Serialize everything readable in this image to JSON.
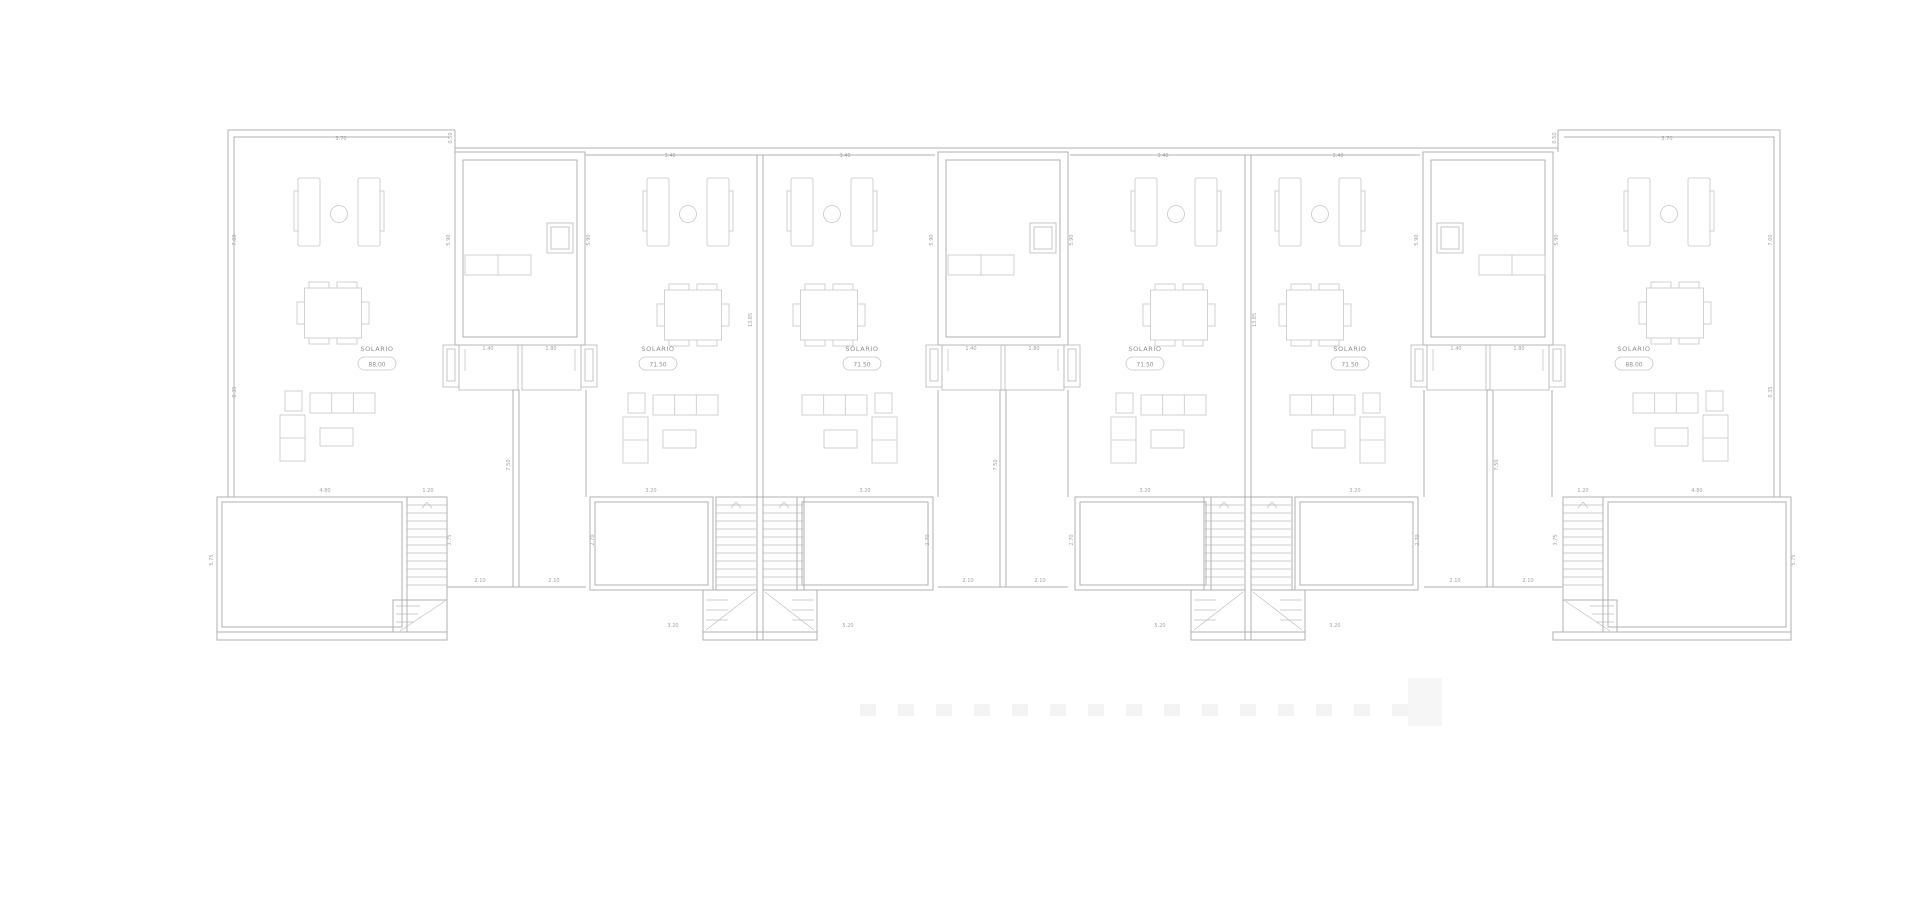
{
  "document": {
    "type": "architectural-floor-plan",
    "level_label": "SOLARIO"
  },
  "plan": {
    "solario_labels": [
      {
        "label": "SOLARIO",
        "value": "88.00",
        "x": 377,
        "y": 351
      },
      {
        "label": "SOLARIO",
        "value": "71.50",
        "x": 658,
        "y": 351
      },
      {
        "label": "SOLARIO",
        "value": "71.50",
        "x": 862,
        "y": 351
      },
      {
        "label": "SOLARIO",
        "value": "71.50",
        "x": 1145,
        "y": 351
      },
      {
        "label": "SOLARIO",
        "value": "71.50",
        "x": 1350,
        "y": 351
      },
      {
        "label": "SOLARIO",
        "value": "88.00",
        "x": 1634,
        "y": 351
      }
    ],
    "dimensions": [
      {
        "text": "3.70",
        "x": 341,
        "y": 140,
        "vertical": false
      },
      {
        "text": "3.40",
        "x": 670,
        "y": 157,
        "vertical": false
      },
      {
        "text": "3.40",
        "x": 845,
        "y": 157,
        "vertical": false
      },
      {
        "text": "3.40",
        "x": 1163,
        "y": 157,
        "vertical": false
      },
      {
        "text": "3.40",
        "x": 1338,
        "y": 157,
        "vertical": false
      },
      {
        "text": "3.70",
        "x": 1667,
        "y": 140,
        "vertical": false
      },
      {
        "text": "4.80",
        "x": 325,
        "y": 492,
        "vertical": false
      },
      {
        "text": "1.20",
        "x": 428,
        "y": 492,
        "vertical": false
      },
      {
        "text": "3.20",
        "x": 651,
        "y": 492,
        "vertical": false
      },
      {
        "text": "3.20",
        "x": 865,
        "y": 492,
        "vertical": false
      },
      {
        "text": "3.20",
        "x": 1145,
        "y": 492,
        "vertical": false
      },
      {
        "text": "3.20",
        "x": 1355,
        "y": 492,
        "vertical": false
      },
      {
        "text": "1.20",
        "x": 1583,
        "y": 492,
        "vertical": false
      },
      {
        "text": "4.80",
        "x": 1697,
        "y": 492,
        "vertical": false
      },
      {
        "text": "2.10",
        "x": 480,
        "y": 582,
        "vertical": false
      },
      {
        "text": "2.10",
        "x": 554,
        "y": 582,
        "vertical": false
      },
      {
        "text": "2.10",
        "x": 968,
        "y": 582,
        "vertical": false
      },
      {
        "text": "2.10",
        "x": 1040,
        "y": 582,
        "vertical": false
      },
      {
        "text": "2.10",
        "x": 1455,
        "y": 582,
        "vertical": false
      },
      {
        "text": "2.10",
        "x": 1528,
        "y": 582,
        "vertical": false
      },
      {
        "text": "3.20",
        "x": 673,
        "y": 627,
        "vertical": false
      },
      {
        "text": "5.20",
        "x": 848,
        "y": 627,
        "vertical": false
      },
      {
        "text": "5.20",
        "x": 1160,
        "y": 627,
        "vertical": false
      },
      {
        "text": "3.20",
        "x": 1335,
        "y": 627,
        "vertical": false
      },
      {
        "text": "1.40",
        "x": 488,
        "y": 350,
        "vertical": false
      },
      {
        "text": "1.80",
        "x": 551,
        "y": 350,
        "vertical": false
      },
      {
        "text": "1.40",
        "x": 971,
        "y": 350,
        "vertical": false
      },
      {
        "text": "1.80",
        "x": 1034,
        "y": 350,
        "vertical": false
      },
      {
        "text": "1.40",
        "x": 1456,
        "y": 350,
        "vertical": false
      },
      {
        "text": "1.80",
        "x": 1519,
        "y": 350,
        "vertical": false
      },
      {
        "text": "7.00",
        "x": 236,
        "y": 240,
        "vertical": true
      },
      {
        "text": "7.00",
        "x": 1772,
        "y": 240,
        "vertical": true
      },
      {
        "text": "5.90",
        "x": 450,
        "y": 240,
        "vertical": true
      },
      {
        "text": "5.90",
        "x": 590,
        "y": 240,
        "vertical": true
      },
      {
        "text": "5.90",
        "x": 933,
        "y": 240,
        "vertical": true
      },
      {
        "text": "5.90",
        "x": 1073,
        "y": 240,
        "vertical": true
      },
      {
        "text": "5.90",
        "x": 1418,
        "y": 240,
        "vertical": true
      },
      {
        "text": "5.90",
        "x": 1558,
        "y": 240,
        "vertical": true
      },
      {
        "text": "0.50",
        "x": 452,
        "y": 138,
        "vertical": true
      },
      {
        "text": "0.50",
        "x": 1556,
        "y": 138,
        "vertical": true
      },
      {
        "text": "13.85",
        "x": 752,
        "y": 320,
        "vertical": true
      },
      {
        "text": "13.85",
        "x": 1256,
        "y": 320,
        "vertical": true
      },
      {
        "text": "7.50",
        "x": 510,
        "y": 465,
        "vertical": true
      },
      {
        "text": "7.50",
        "x": 997,
        "y": 465,
        "vertical": true
      },
      {
        "text": "7.50",
        "x": 1498,
        "y": 465,
        "vertical": true
      },
      {
        "text": "3.75",
        "x": 451,
        "y": 540,
        "vertical": true
      },
      {
        "text": "3.75",
        "x": 1557,
        "y": 540,
        "vertical": true
      },
      {
        "text": "2.70",
        "x": 594,
        "y": 540,
        "vertical": true
      },
      {
        "text": "2.70",
        "x": 929,
        "y": 540,
        "vertical": true
      },
      {
        "text": "2.70",
        "x": 1073,
        "y": 540,
        "vertical": true
      },
      {
        "text": "2.70",
        "x": 1419,
        "y": 540,
        "vertical": true
      },
      {
        "text": "0.35",
        "x": 236,
        "y": 392,
        "vertical": true
      },
      {
        "text": "0.35",
        "x": 1772,
        "y": 392,
        "vertical": true
      },
      {
        "text": "5.75",
        "x": 213,
        "y": 560,
        "vertical": true
      },
      {
        "text": "5.75",
        "x": 1795,
        "y": 560,
        "vertical": true
      }
    ],
    "watermark": {
      "visible": true
    }
  }
}
